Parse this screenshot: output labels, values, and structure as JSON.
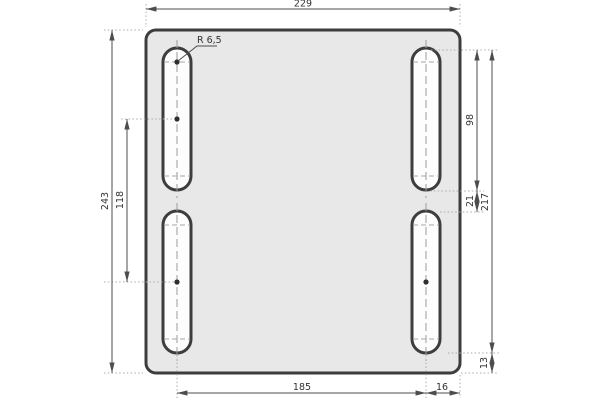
{
  "drawing": {
    "kind": "technical-dimension-drawing",
    "part": "rectangular mounting plate with four vertical slotted holes",
    "dimensions": {
      "overall_width": "229",
      "overall_height": "243",
      "left_slot_center_spacing": "118",
      "slot_length": "98",
      "slot_vertical_gap": "21",
      "slots_total_extent": "217",
      "bottom_edge_offset": "13",
      "slot_horizontal_spacing": "185",
      "right_edge_offset": "16",
      "slot_end_radius": "R 6,5"
    },
    "colors": {
      "background": "#ffffff",
      "plate_fill": "#e8e8e8",
      "outline_stroke": "#3d3d3d",
      "dimension_stroke": "#4d4d4d",
      "extension_stroke": "#ababab",
      "text": "#333333"
    }
  }
}
